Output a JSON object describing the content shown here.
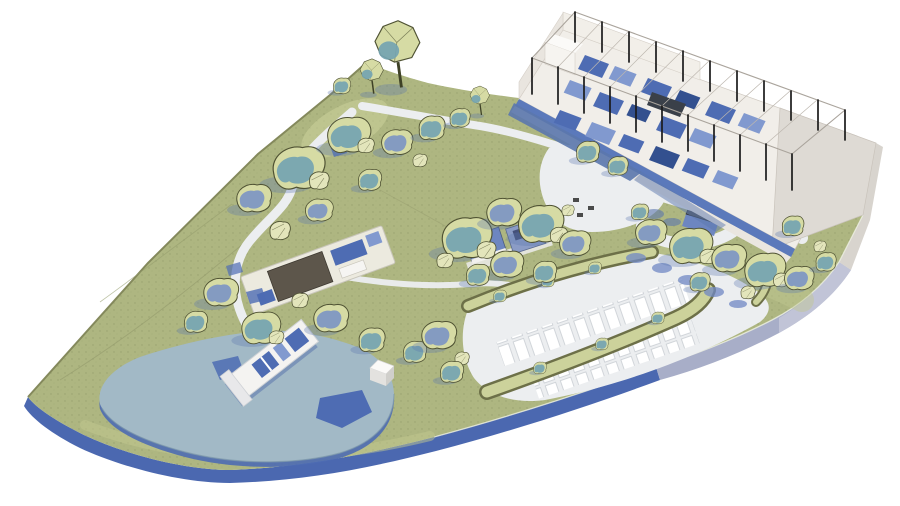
{
  "scene": {
    "type": "architectural-site-plan-3d",
    "description": "Isometric 3D masterplan render of a landscaped park site on white background"
  },
  "palette": {
    "bg": "#ffffff",
    "terrain": "#aeb681",
    "terrain-light": "#ccd29b",
    "terrain-dark": "#8f9a66",
    "tree-base": "#d6dba4",
    "tree-teal": "#74a4b1",
    "tree-blue": "#7b93c4",
    "tree-outline": "#4f5233",
    "rock": "#e3e5bb",
    "water": "#a2b9c6",
    "water-deep": "#4e6cb3",
    "path": "#eceef0",
    "plinth": "#f1eee9",
    "terrace": "#dedad4",
    "edge-blue": "#4b68b0",
    "edge-lavender": "#a8aec8",
    "edge-light": "#d8d4ce",
    "column": "#1b1b1b",
    "furniture-blue": "#4e6cb3",
    "furniture-blue-light": "#8199cf",
    "furniture-blue-dark": "#33508f",
    "roof-dark": "#5d564b",
    "shadow-blue": "#5b77ad",
    "berm-outline": "#6d7048",
    "white": "#fbfaf8"
  },
  "features": {
    "site": "flat leaf-shaped terrain island, pointed west",
    "hill_forest": "wooded hill with low-poly trees, north-west",
    "canopy_building": "open column-frame pavilion with blue fit-out, north-east",
    "terrace": "paved terrace east of pavilion",
    "arrival_loop": "hairpin drop-off road with flat-roof kiosks",
    "parking": "two rows of white parking stalls with planted berms",
    "pond": "large pond, south-west, with deep-blue patches",
    "pier": "white jetty with blue panels reaching into pond",
    "spa_building": "long deck building with dark roof and pools, west",
    "center_grove": "tree grove with two blue-roof garden buildings",
    "paths": "white winding footpaths linking hill, spa, pier, grove and plaza"
  }
}
